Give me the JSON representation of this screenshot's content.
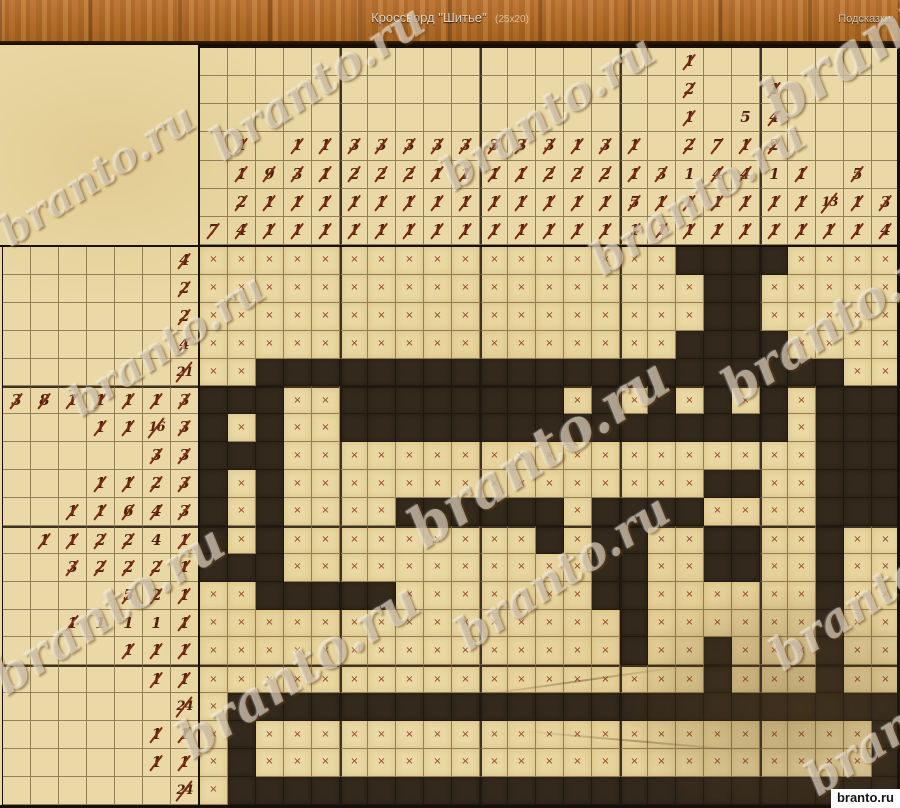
{
  "header": {
    "title": "Кроссворд \"Шитье\"",
    "size_label": "(25x20)",
    "hints_label": "Подсказки:"
  },
  "watermark_text": "branto.ru",
  "site_badge": "branto.ru",
  "colors": {
    "wood": "#b06a28",
    "parchment": "#ead9a6",
    "grid_line_minor": "#584426",
    "grid_line_major": "#17100a",
    "cell_filled": "#33291c",
    "clue_digit": "#54200e",
    "strike_slash": "#7c2c12",
    "x_mark": "#862b14",
    "title_text": "#ddd5c5"
  },
  "puzzle": {
    "cols": 25,
    "rows": 20,
    "col_clues": [
      [
        "7"
      ],
      [
        "1",
        "1",
        "2",
        "4"
      ],
      [
        "9",
        "1",
        "1"
      ],
      [
        "1",
        "3",
        "1",
        "1"
      ],
      [
        "1",
        "1",
        "1",
        "1"
      ],
      [
        "3",
        "2",
        "1",
        "1"
      ],
      [
        "3",
        "2",
        "1",
        "1"
      ],
      [
        "3",
        "2",
        "1",
        "1"
      ],
      [
        "3",
        "1",
        "1",
        "1"
      ],
      [
        "3",
        "1",
        "1",
        "1"
      ],
      [
        "3",
        "1",
        "1",
        "1"
      ],
      [
        "3",
        "1",
        "1",
        "1"
      ],
      [
        "3",
        "2",
        "1",
        "1"
      ],
      [
        "1",
        "2",
        "1",
        "1"
      ],
      [
        "3",
        "2",
        "1",
        "1"
      ],
      [
        "1",
        "1",
        "5",
        "1"
      ],
      [
        "3",
        "1",
        "1"
      ],
      [
        "1",
        "2",
        "1",
        "2",
        "!1",
        "1",
        "1"
      ],
      [
        "7",
        "4",
        "1",
        "1"
      ],
      [
        "!5",
        "1",
        "4",
        "1",
        "1"
      ],
      [
        "1",
        "4",
        "2",
        "!1",
        "1",
        "1"
      ],
      [
        "1",
        "1",
        "1"
      ],
      [
        "13",
        "1"
      ],
      [
        "5",
        "1",
        "1"
      ],
      [
        "3",
        "4"
      ]
    ],
    "row_clues": [
      [
        "4"
      ],
      [
        "2"
      ],
      [
        "2"
      ],
      [
        "4"
      ],
      [
        "21"
      ],
      [
        "3",
        "8",
        "1",
        "1",
        "1",
        "1",
        "3"
      ],
      [
        "1",
        "1",
        "16",
        "3"
      ],
      [
        "3",
        "3"
      ],
      [
        "1",
        "1",
        "2",
        "3"
      ],
      [
        "1",
        "1",
        "6",
        "4",
        "3"
      ],
      [
        "1",
        "1",
        "2",
        "2",
        "!4",
        "1"
      ],
      [
        "3",
        "2",
        "2",
        "2",
        "1"
      ],
      [
        "5",
        "2",
        "1"
      ],
      [
        "1",
        "!1",
        "!1",
        "!1",
        "1"
      ],
      [
        "1",
        "1",
        "1"
      ],
      [
        "1",
        "1"
      ],
      [
        "24"
      ],
      [
        "1",
        "1"
      ],
      [
        "1",
        "1"
      ],
      [
        "24"
      ]
    ],
    "grid": [
      ".................####....",
      "..................##.....",
      "..................##.....",
      ".................####....",
      "..#####################..",
      "###..########.#.#.#.#.###",
      "#.#..################.###",
      "###...................###",
      "#.#...............##..###",
      "#.#....######.####....###",
      "#.#.........#.##..##..#..",
      "###...........##..##..#..",
      "..#####.......##......#..",
      "...............#......#..",
      "...............#..#...#..",
      "..................#...#..",
      ".########################",
      ".#......................#",
      ".#......................#",
      ".########################"
    ]
  },
  "watermarks": [
    {
      "left": 740,
      "top": -18,
      "size": 62,
      "rot": -33
    },
    {
      "left": 195,
      "top": 55,
      "size": 46,
      "rot": -33
    },
    {
      "left": -15,
      "top": 150,
      "size": 42,
      "rot": -33
    },
    {
      "left": 425,
      "top": 85,
      "size": 46,
      "rot": -33
    },
    {
      "left": 575,
      "top": 170,
      "size": 46,
      "rot": -33
    },
    {
      "left": 705,
      "top": 290,
      "size": 50,
      "rot": -33
    },
    {
      "left": 390,
      "top": 420,
      "size": 56,
      "rot": -33
    },
    {
      "left": 55,
      "top": 320,
      "size": 42,
      "rot": -33
    },
    {
      "left": -25,
      "top": 580,
      "size": 50,
      "rot": -33
    },
    {
      "left": 160,
      "top": 640,
      "size": 52,
      "rot": -33
    },
    {
      "left": 440,
      "top": 545,
      "size": 46,
      "rot": -33
    },
    {
      "left": 755,
      "top": 565,
      "size": 46,
      "rot": -33
    },
    {
      "left": 790,
      "top": 690,
      "size": 46,
      "rot": -33
    }
  ]
}
